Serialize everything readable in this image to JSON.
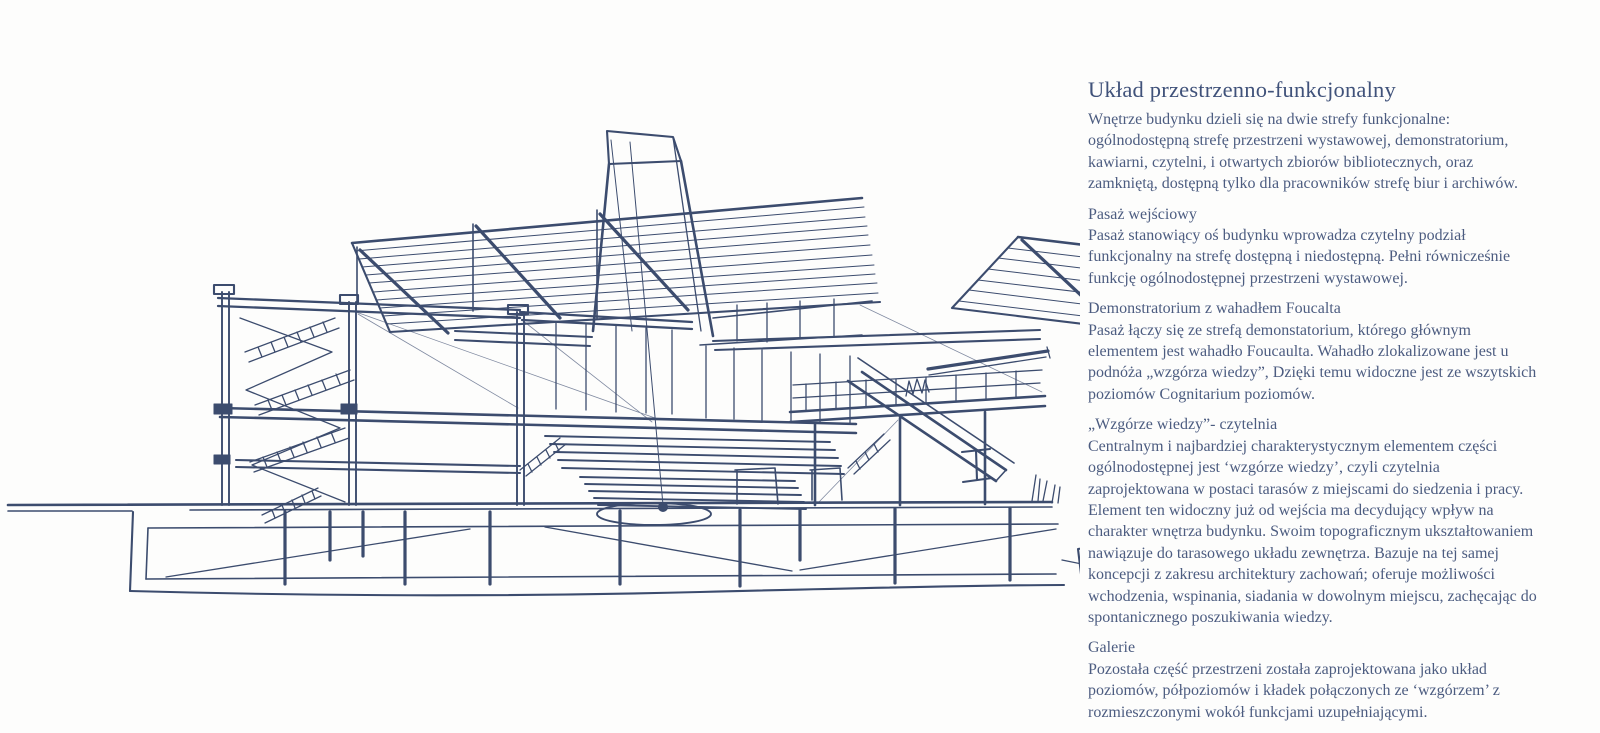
{
  "page": {
    "background_color": "#fdfdfc",
    "ink_color": "#3c4c6e",
    "title_color": "#40527a",
    "body_text_color": "#4c5c80"
  },
  "sketch": {
    "ink_color": "#3c4c6e",
    "alt": "Hand-drawn sectional perspective sketch of the building: Foucault pendulum under a tall funnel skylight, terraced 'hill of knowledge' reading steps, multi-storey frame with zigzag stairs, louvered roof planes, side ramp and basement piles"
  },
  "article": {
    "title": "Układ przestrzenno-funkcjonalny",
    "intro": "Wnętrze budynku dzieli się na dwie strefy funkcjonalne: ogólnodostępną strefę przestrzeni wystawowej, demonstratorium, kawiarni, czytelni, i otwartych zbiorów bibliotecznych, oraz zamkniętą, dostępną tylko dla pracowników strefę biur i archiwów.",
    "sections": [
      {
        "heading": "Pasaż wejściowy",
        "body": "Pasaż stanowiący oś budynku wprowadza czytelny podział funkcjonalny na strefę dostępną i niedostępną. Pełni równicześnie funkcję ogólnodostępnej przestrzeni wystawowej."
      },
      {
        "heading": "Demonstratorium z wahadłem Foucalta",
        "body": "Pasaż łączy się ze strefą demonstatorium, którego głównym elementem jest wahadło Foucaulta. Wahadło zlokalizowane jest u podnóża „wzgórza wiedzy”, Dzięki temu widoczne jest ze wszytskich poziomów Cognitarium poziomów."
      },
      {
        "heading": "„Wzgórze wiedzy”- czytelnia",
        "body": "Centralnym i najbardziej charakterystycznym elementem części ogólnodostępnej jest ‘wzgórze wiedzy’, czyli czytelnia zaprojektowana w postaci tarasów z miejscami do siedzenia i pracy. Element ten widoczny już od wejścia ma decydujący wpływ na charakter wnętrza budynku. Swoim topograficznym ukształtowaniem nawiązuje do tarasowego układu zewnętrza. Bazuje na tej samej koncepcji z zakresu architektury zachowań; oferuje możliwości wchodzenia, wspinania, siadania w dowolnym miejscu, zachęcając do spontanicznego poszukiwania wiedzy."
      },
      {
        "heading": "Galerie",
        "body": "Pozostała część przestrzeni została zaprojektowana jako układ poziomów, półpoziomów i kładek połączonych ze ‘wzgórzem’ z rozmieszczonymi wokół funkcjami uzupełniającymi."
      }
    ]
  }
}
